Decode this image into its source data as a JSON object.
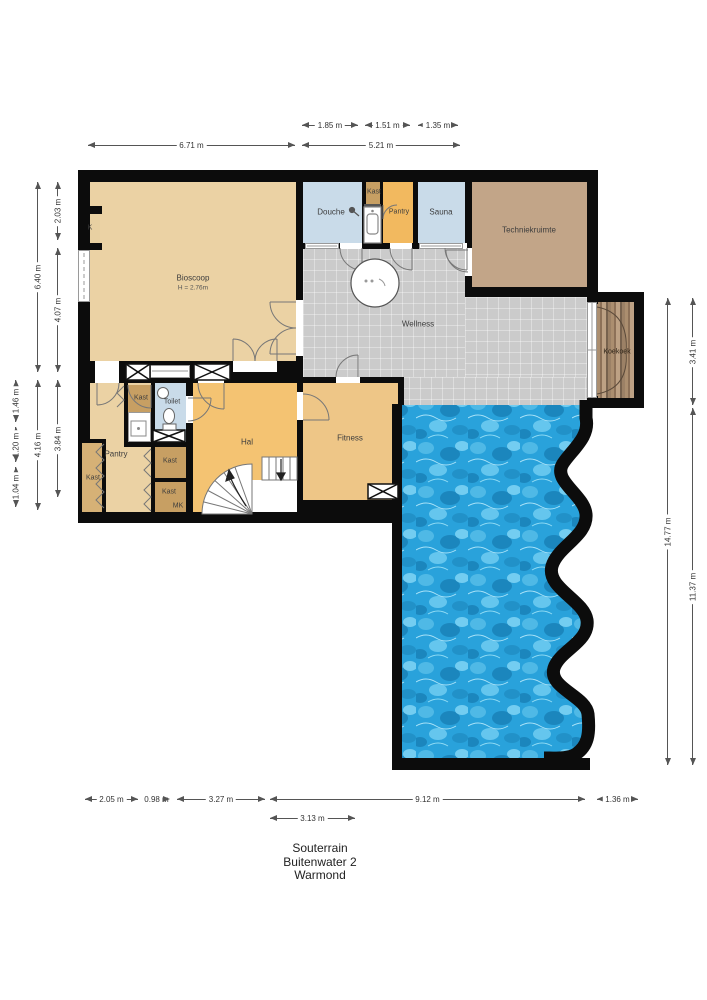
{
  "title_block": {
    "line1": "Souterrain",
    "line2": "Buitenwater 2",
    "line3": "Warmond"
  },
  "rooms": {
    "bioscoop": {
      "label": "Bioscoop",
      "sub": "H = 2.76m"
    },
    "douche": {
      "label": "Douche"
    },
    "kast_top": {
      "label": "Kast"
    },
    "pantry_top": {
      "label": "Pantry"
    },
    "sauna": {
      "label": "Sauna"
    },
    "techniekruimte": {
      "label": "Techniekruimte"
    },
    "wellness": {
      "label": "Wellness"
    },
    "koekoek": {
      "label": "Koekoek"
    },
    "k_closet": {
      "label": "K"
    },
    "kast_mid": {
      "label": "Kast"
    },
    "toilet": {
      "label": "Toilet"
    },
    "pantry_left": {
      "label": "Pantry"
    },
    "kast_left": {
      "label": "Kast"
    },
    "kast_c1": {
      "label": "Kast"
    },
    "kast_c2": {
      "label": "Kast"
    },
    "mk": {
      "label": "MK"
    },
    "hal": {
      "label": "Hal"
    },
    "fitness": {
      "label": "Fitness"
    }
  },
  "dimensions": {
    "top_row1": [
      "1.85 m",
      "1.51 m",
      "1.35 m"
    ],
    "top_row2": [
      "6.71 m",
      "5.21 m"
    ],
    "left_inner": [
      "2.03 m",
      "4.07 m",
      "3.84 m"
    ],
    "left_mid": [
      "6.40 m",
      "4.16 m"
    ],
    "left_outer": [
      "1.46 m",
      "1.20 m",
      "1.04 m"
    ],
    "right": [
      "14.77 m",
      "3.41 m",
      "11.37 m"
    ],
    "bottom_row1": [
      "2.05 m",
      "0.98 m",
      "3.27 m",
      "9.12 m",
      "1.36 m"
    ],
    "bottom_row2": [
      "3.13 m"
    ]
  },
  "palette": {
    "wall": "#0c0c0c",
    "tan_room": "#ebd2a4",
    "orange_hall": "#f4c372",
    "orange_pantry": "#f2b95f",
    "fitness": "#eec687",
    "closet_brown": "#c79f63",
    "wet_room_blue": "#c9dbe9",
    "tech_brown": "#c2a588",
    "wellness_grey": "#cbcbcb",
    "pool_blue": "#29a2db",
    "wood": "#ab8e6f",
    "background": "#ffffff"
  }
}
